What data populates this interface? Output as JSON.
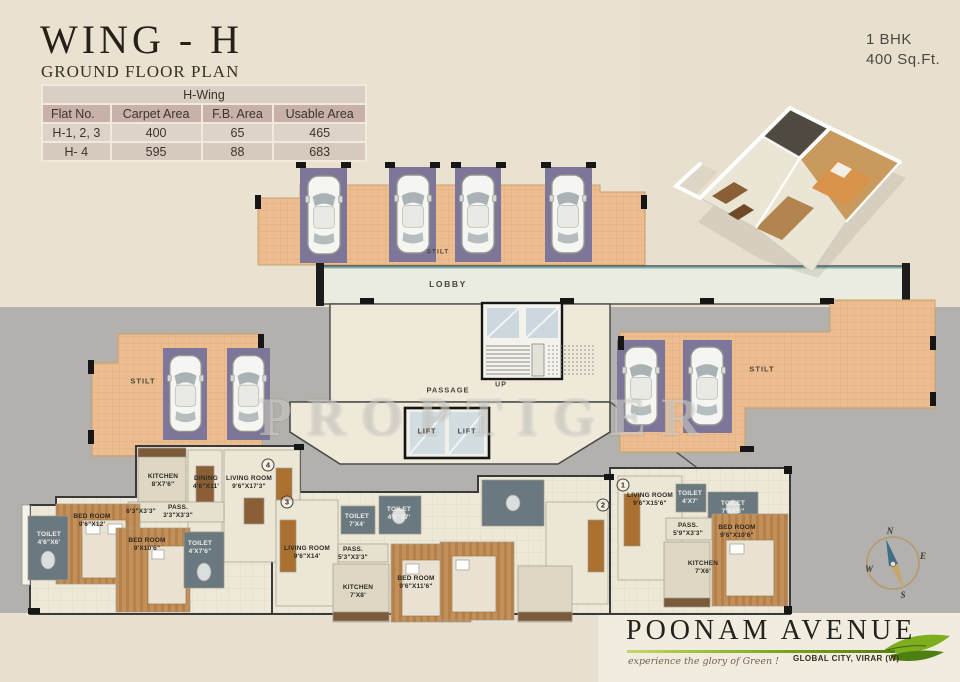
{
  "header": {
    "title": "WING - H",
    "subtitle": "GROUND FLOOR PLAN"
  },
  "unit_info": {
    "type": "1 BHK",
    "area": "400 Sq.Ft."
  },
  "area_table": {
    "title": "H-Wing",
    "columns": [
      "Flat No.",
      "Carpet Area",
      "F.B. Area",
      "Usable Area"
    ],
    "rows": [
      {
        "flat": "H-1, 2, 3",
        "carpet": "400",
        "fb": "65",
        "usable": "465"
      },
      {
        "flat": "H- 4",
        "carpet": "595",
        "fb": "88",
        "usable": "683"
      }
    ]
  },
  "plan": {
    "watermark": "PROPTIGER",
    "areas": {
      "stilt_top": "STILT",
      "stilt_left": "STILT",
      "stilt_right": "STILT",
      "lobby": "LOBBY",
      "passage": "PASSAGE",
      "up": "UP",
      "lift": "LIFT"
    },
    "flat_markers": {
      "f1": "1",
      "f2": "2",
      "f3": "3",
      "f4": "4"
    },
    "rooms": {
      "f4_kitchen": {
        "name": "KITCHEN",
        "dims": "8'X7'6\""
      },
      "f4_dining": {
        "name": "DINING",
        "dims": "4'6\"X11'"
      },
      "f4_living": {
        "name": "LIVING ROOM",
        "dims": "9'6\"X17'3\""
      },
      "f4_pass2": {
        "name": "",
        "dims": "6'3\"X3'3\""
      },
      "f4_pass1": {
        "name": "PASS.",
        "dims": "3'3\"X3'3\""
      },
      "f4_bed1": {
        "name": "BED ROOM",
        "dims": "9'6\"X12'"
      },
      "f4_toilet1": {
        "name": "TOILET",
        "dims": "4'6\"X6'"
      },
      "f4_bed2": {
        "name": "BED ROOM",
        "dims": "9'X10'6\""
      },
      "f4_toilet2": {
        "name": "TOILET",
        "dims": "4'X7'6\""
      },
      "f3_toilet2": {
        "name": "TOILET",
        "dims": "4'6\"X7'"
      },
      "f3_toilet1": {
        "name": "TOILET",
        "dims": "7'X4'"
      },
      "f3_living": {
        "name": "LIVING ROOM",
        "dims": "9'6\"X14'"
      },
      "f3_pass": {
        "name": "PASS.",
        "dims": "5'3\"X3'3\""
      },
      "f3_bed": {
        "name": "BED ROOM",
        "dims": "9'6\"X11'6\""
      },
      "f3_kitchen": {
        "name": "KITCHEN",
        "dims": "7'X8'"
      },
      "f1_living": {
        "name": "LIVING ROOM",
        "dims": "9'6\"X15'6\""
      },
      "f1_toilet1": {
        "name": "TOILET",
        "dims": "4'X7'"
      },
      "f1_toilet2": {
        "name": "TOILET",
        "dims": "7'X4'6\""
      },
      "f1_pass": {
        "name": "PASS.",
        "dims": "5'9\"X3'3\""
      },
      "f1_bed": {
        "name": "BED ROOM",
        "dims": "9'6\"X10'6\""
      },
      "f1_kitchen": {
        "name": "KITCHEN",
        "dims": "7'X6'"
      }
    },
    "compass": {
      "n": "N",
      "e": "E",
      "s": "S",
      "w": "W"
    }
  },
  "footer": {
    "brand": "POONAM AVENUE",
    "tagline": "experience the glory of Green !",
    "location": "GLOBAL CITY, VIRAR (W)"
  },
  "colors": {
    "accent_green": "#76a416",
    "stall_purple": "#7d7698",
    "stilt_tan": "#ecbd90",
    "band_gray": "#b3b1ad",
    "paper_beige": "#e9e1cf",
    "wall_dark": "#3a3a3a"
  }
}
